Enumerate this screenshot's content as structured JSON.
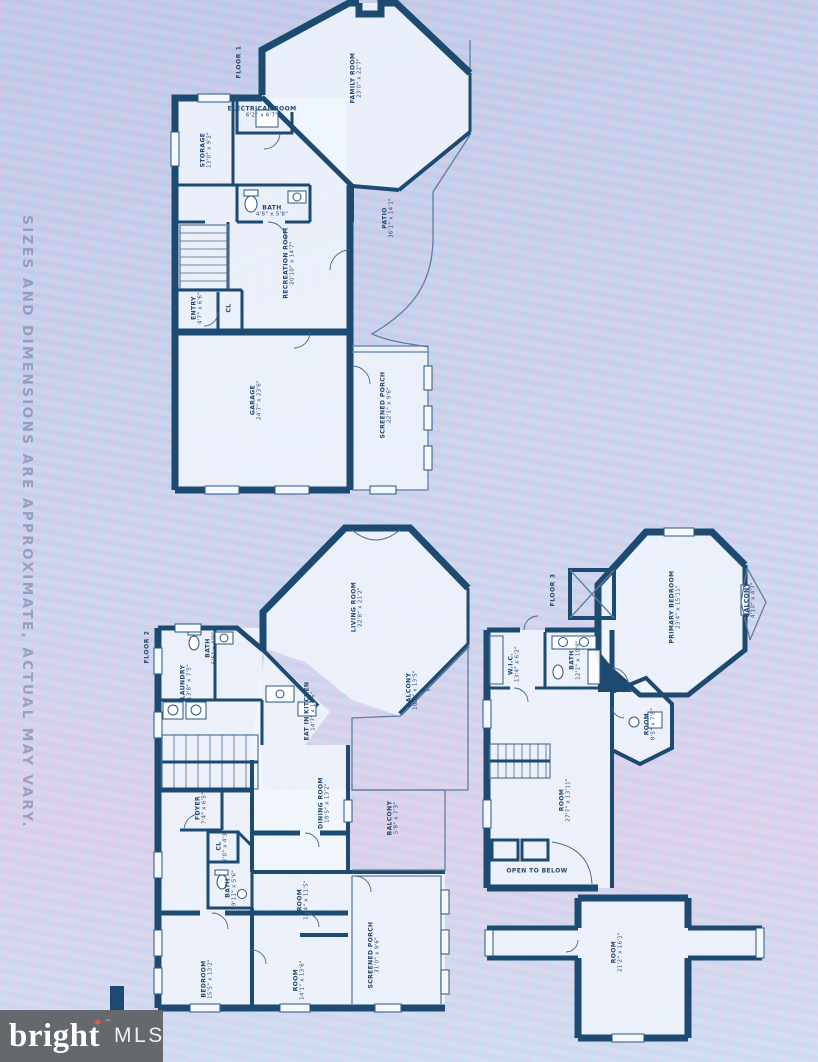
{
  "watermark": "SIZES AND DIMENSIONS ARE APPROXIMATE, ACTUAL MAY VARY.",
  "logo": {
    "brand": "bright",
    "tm": "™",
    "suffix": "MLS"
  },
  "colors": {
    "plan_ink": "#1c4a70",
    "background": "#cdd5ec",
    "logo_bg": "#65686c",
    "star_accent": "#e2603c"
  },
  "floors": [
    {
      "label": "FLOOR 1",
      "rooms": [
        {
          "name": "FAMILY ROOM",
          "dims": "23'0\" x 22'7\""
        },
        {
          "name": "ELECTRICAL ROOM",
          "dims": "6'2\" x 6'7\""
        },
        {
          "name": "STORAGE",
          "dims": "13'0\" x 9'2\""
        },
        {
          "name": "BATH",
          "dims": "4'6\" x 5'8\""
        },
        {
          "name": "RECREATION ROOM",
          "dims": "20'10\" x 14'7\""
        },
        {
          "name": "ENTRY",
          "dims": "4'7\" x 6'6\""
        },
        {
          "name": "CL",
          "dims": ""
        },
        {
          "name": "GARAGE",
          "dims": "24'7\" x 23'6\""
        },
        {
          "name": "SCREENED PORCH",
          "dims": "22'1\" x 9'6\""
        },
        {
          "name": "PATIO",
          "dims": "36'1\" x 14'1\""
        }
      ]
    },
    {
      "label": "FLOOR 2",
      "rooms": [
        {
          "name": "LIVING ROOM",
          "dims": "22'8\" x 21'2\""
        },
        {
          "name": "BATH",
          "dims": "5'5\" x 4'9\""
        },
        {
          "name": "LAUNDRY",
          "dims": "13'8\" x 7'5\""
        },
        {
          "name": "EAT IN KITCHEN",
          "dims": "14'7\" x 14'6\""
        },
        {
          "name": "BALCONY",
          "dims": "18'4\" x 13'5\""
        },
        {
          "name": "DINING ROOM",
          "dims": "18'5\" x 13'2\""
        },
        {
          "name": "BALCONY",
          "dims": "5'8\" x 7'3\""
        },
        {
          "name": "FOYER",
          "dims": "7'4\" x 6'5\""
        },
        {
          "name": "CL",
          "dims": "2'0\" x 4'3\""
        },
        {
          "name": "BATH",
          "dims": "9'11\" x 5'6\""
        },
        {
          "name": "ROOM",
          "dims": "14'4\" x 11'5\""
        },
        {
          "name": "BEDROOM",
          "dims": "15'5\" x 13'2\""
        },
        {
          "name": "ROOM",
          "dims": "14'1\" x 13'6\""
        },
        {
          "name": "SCREENED PORCH",
          "dims": "31'0\" x 9'6\""
        }
      ]
    },
    {
      "label": "FLOOR 3",
      "rooms": [
        {
          "name": "PRIMARY BEDROOM",
          "dims": "23'4\" x 15'11\""
        },
        {
          "name": "BALCONY",
          "dims": "4'10\" x 4'7\""
        },
        {
          "name": "BATH",
          "dims": "12'1\" x 10'8\""
        },
        {
          "name": "W.I.C.",
          "dims": "13'4\" x 6'2\""
        },
        {
          "name": "ROOM",
          "dims": "8'5\" x 7'8\""
        },
        {
          "name": "ROOM",
          "dims": "27'7\" x 13'11\""
        },
        {
          "name": "OPEN TO BELOW",
          "dims": ""
        },
        {
          "name": "ROOM",
          "dims": "21'2\" x 16'1\""
        }
      ]
    }
  ]
}
